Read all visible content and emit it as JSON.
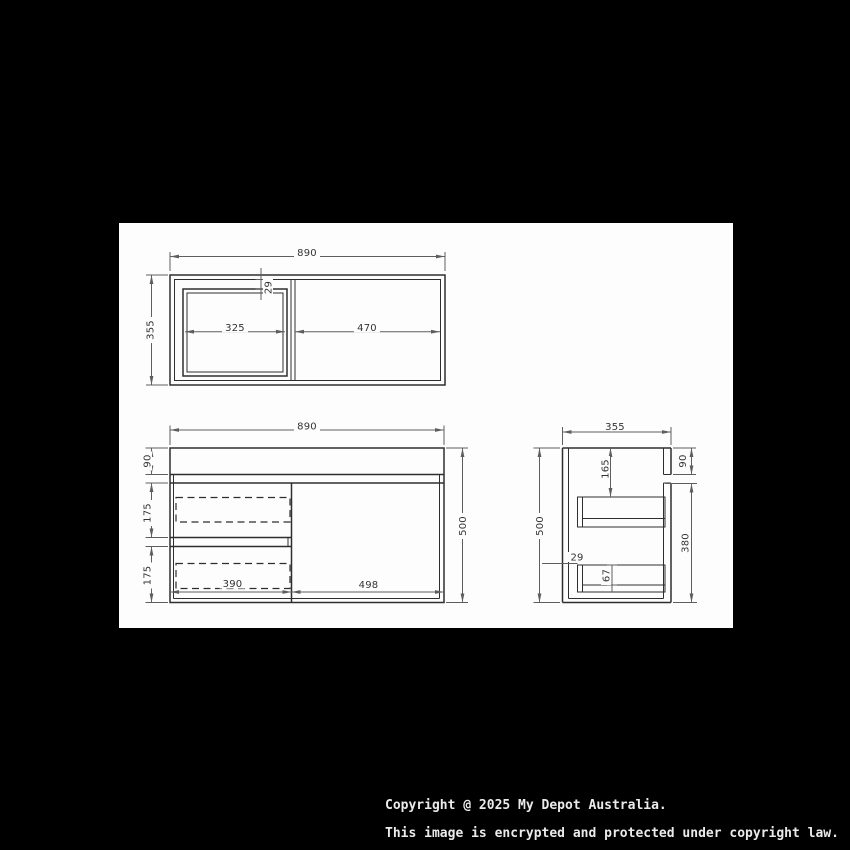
{
  "page": {
    "background": "#000000",
    "paper_color": "#fdfdfd",
    "object_line_color": "#2e2e2e",
    "dimension_line_color": "#5e5e5e"
  },
  "drawing": {
    "top_view": {
      "width": "890",
      "depth": "355",
      "left_width": "325",
      "right_width": "470",
      "setback": "29"
    },
    "front_view": {
      "width": "890",
      "height": "500",
      "benchtop": "90",
      "drawer1": "175",
      "drawer2": "175",
      "left_width": "390",
      "right_width": "498"
    },
    "side_view": {
      "depth": "355",
      "height": "500",
      "benchtop": "90",
      "top_offset": "165",
      "body_height": "380",
      "setback": "29",
      "drawer_depth": "67"
    }
  },
  "footer": {
    "line1": "Copyright @ 2025 My Depot Australia.",
    "line2": "This image is encrypted and protected under copyright law."
  }
}
